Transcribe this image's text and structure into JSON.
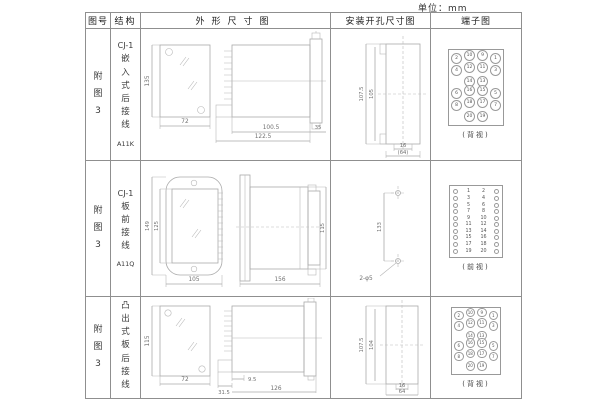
{
  "unit_label": "单位：mm",
  "header": {
    "fig": "图号",
    "structure": "结构",
    "outline": "外形尺寸图",
    "install": "安装开孔尺寸图",
    "terminal": "端子图"
  },
  "rows": [
    {
      "fig": "附图3",
      "model_prefix": "CJ-1",
      "structure_name": "嵌入式后接线",
      "model": "A11K",
      "outline": {
        "h": "135",
        "w": "72",
        "d1": "100.5",
        "d2": "122.5",
        "d3": "35"
      },
      "install": {
        "v1": "107.5",
        "v2": "105",
        "h1": "16",
        "h2": "(64)"
      },
      "terminal": {
        "view": "(背视)",
        "grid": [
          [
            "2",
            "10",
            "9",
            "1"
          ],
          [
            "4",
            "12",
            "11",
            "3"
          ],
          [
            "14",
            "13"
          ],
          [
            "6",
            "16",
            "15",
            "5"
          ],
          [
            "8",
            "18",
            "17",
            "7"
          ],
          [
            "20",
            "19"
          ]
        ]
      }
    },
    {
      "fig": "附图3",
      "model_prefix": "CJ-1",
      "structure_name": "板前接线",
      "model": "A11Q",
      "outline": {
        "h1": "149",
        "h2": "125",
        "w": "105",
        "d": "156",
        "side_h": "115"
      },
      "install": {
        "v": "133",
        "hole": "2-φ5"
      },
      "terminal": {
        "view": "(前视)",
        "left": [
          "1",
          "3",
          "5",
          "7",
          "9",
          "11",
          "13",
          "15",
          "17",
          "19"
        ],
        "right": [
          "2",
          "4",
          "6",
          "8",
          "10",
          "12",
          "14",
          "16",
          "18",
          "20"
        ]
      }
    },
    {
      "fig": "附图3",
      "model_prefix": "CJ-1",
      "structure_name": "凸出式板后接线",
      "model": "A11H",
      "outline": {
        "h": "115",
        "w": "72",
        "d1": "31.5",
        "d2": "9.5",
        "d3": "126"
      },
      "install": {
        "v1": "107.5",
        "v2": "104",
        "h1": "16",
        "h2": "64"
      },
      "terminal": {
        "view": "(背视)",
        "grid": [
          [
            "2",
            "10",
            "9",
            "1"
          ],
          [
            "4",
            "12",
            "11",
            "3"
          ],
          [
            "14",
            "13"
          ],
          [
            "6",
            "16",
            "15",
            "5"
          ],
          [
            "8",
            "18",
            "17",
            "7"
          ],
          [
            "20",
            "19"
          ]
        ]
      }
    }
  ]
}
